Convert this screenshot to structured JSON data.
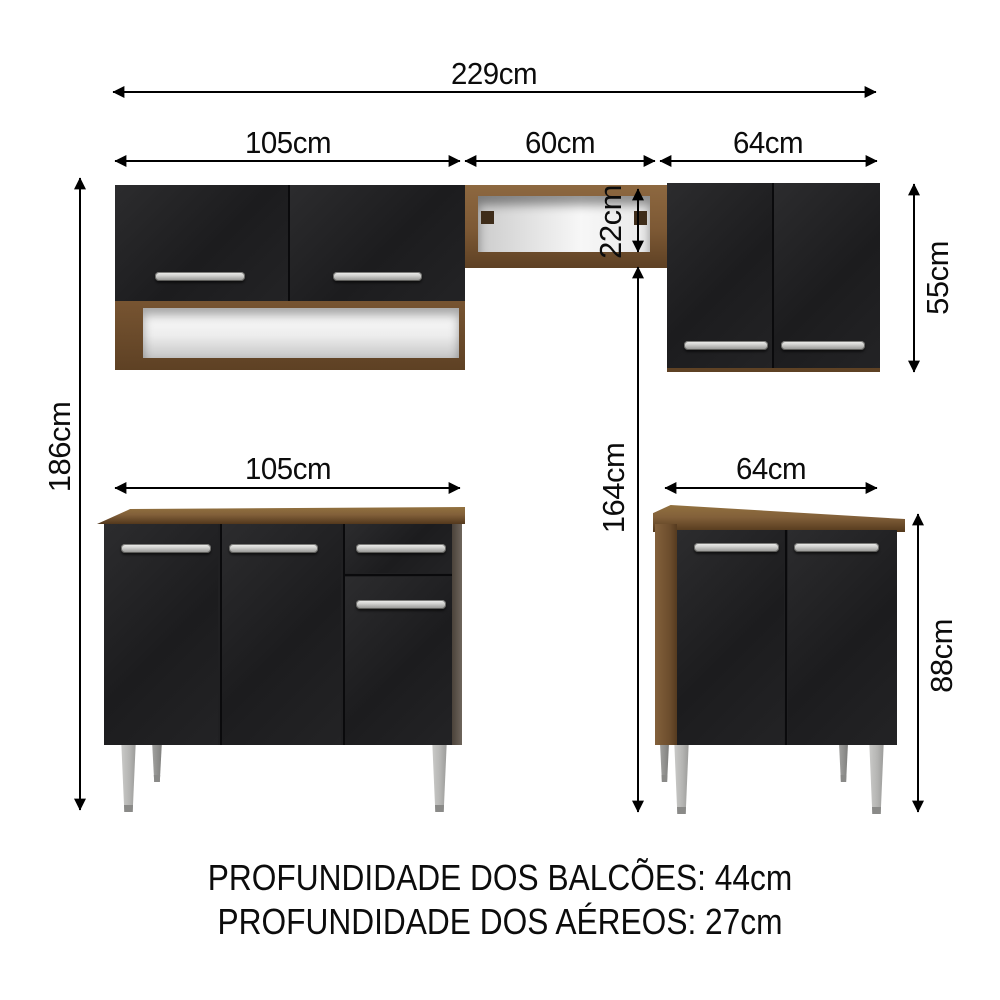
{
  "diagram": {
    "title": "kitchen-cabinet-set-dimensions",
    "dimensions": {
      "overall_width": "229cm",
      "upper_left_cabinet_width": "105cm",
      "upper_middle_shelf_width": "60cm",
      "upper_right_cabinet_width": "64cm",
      "overall_height": "186cm",
      "upper_right_cabinet_height": "55cm",
      "middle_shelf_height": "22cm",
      "shelf_to_floor_height": "164cm",
      "lower_left_counter_width": "105cm",
      "lower_right_cabinet_width": "64cm",
      "lower_cabinet_height": "88cm"
    },
    "footer": {
      "line1": "PROFUNDIDADE DOS BALCÕES: 44cm",
      "line2": "PROFUNDIDADE DOS AÉREOS: 27cm"
    },
    "colors": {
      "background": "#ffffff",
      "wood": "#82603a",
      "wood_dark": "#5c3f22",
      "door_black": "#1f1f21",
      "handle_silver": "#c9c9c7",
      "leg_gray": "#b4b4b2",
      "niche_white": "#ededed",
      "dimension_line": "#000000"
    }
  }
}
